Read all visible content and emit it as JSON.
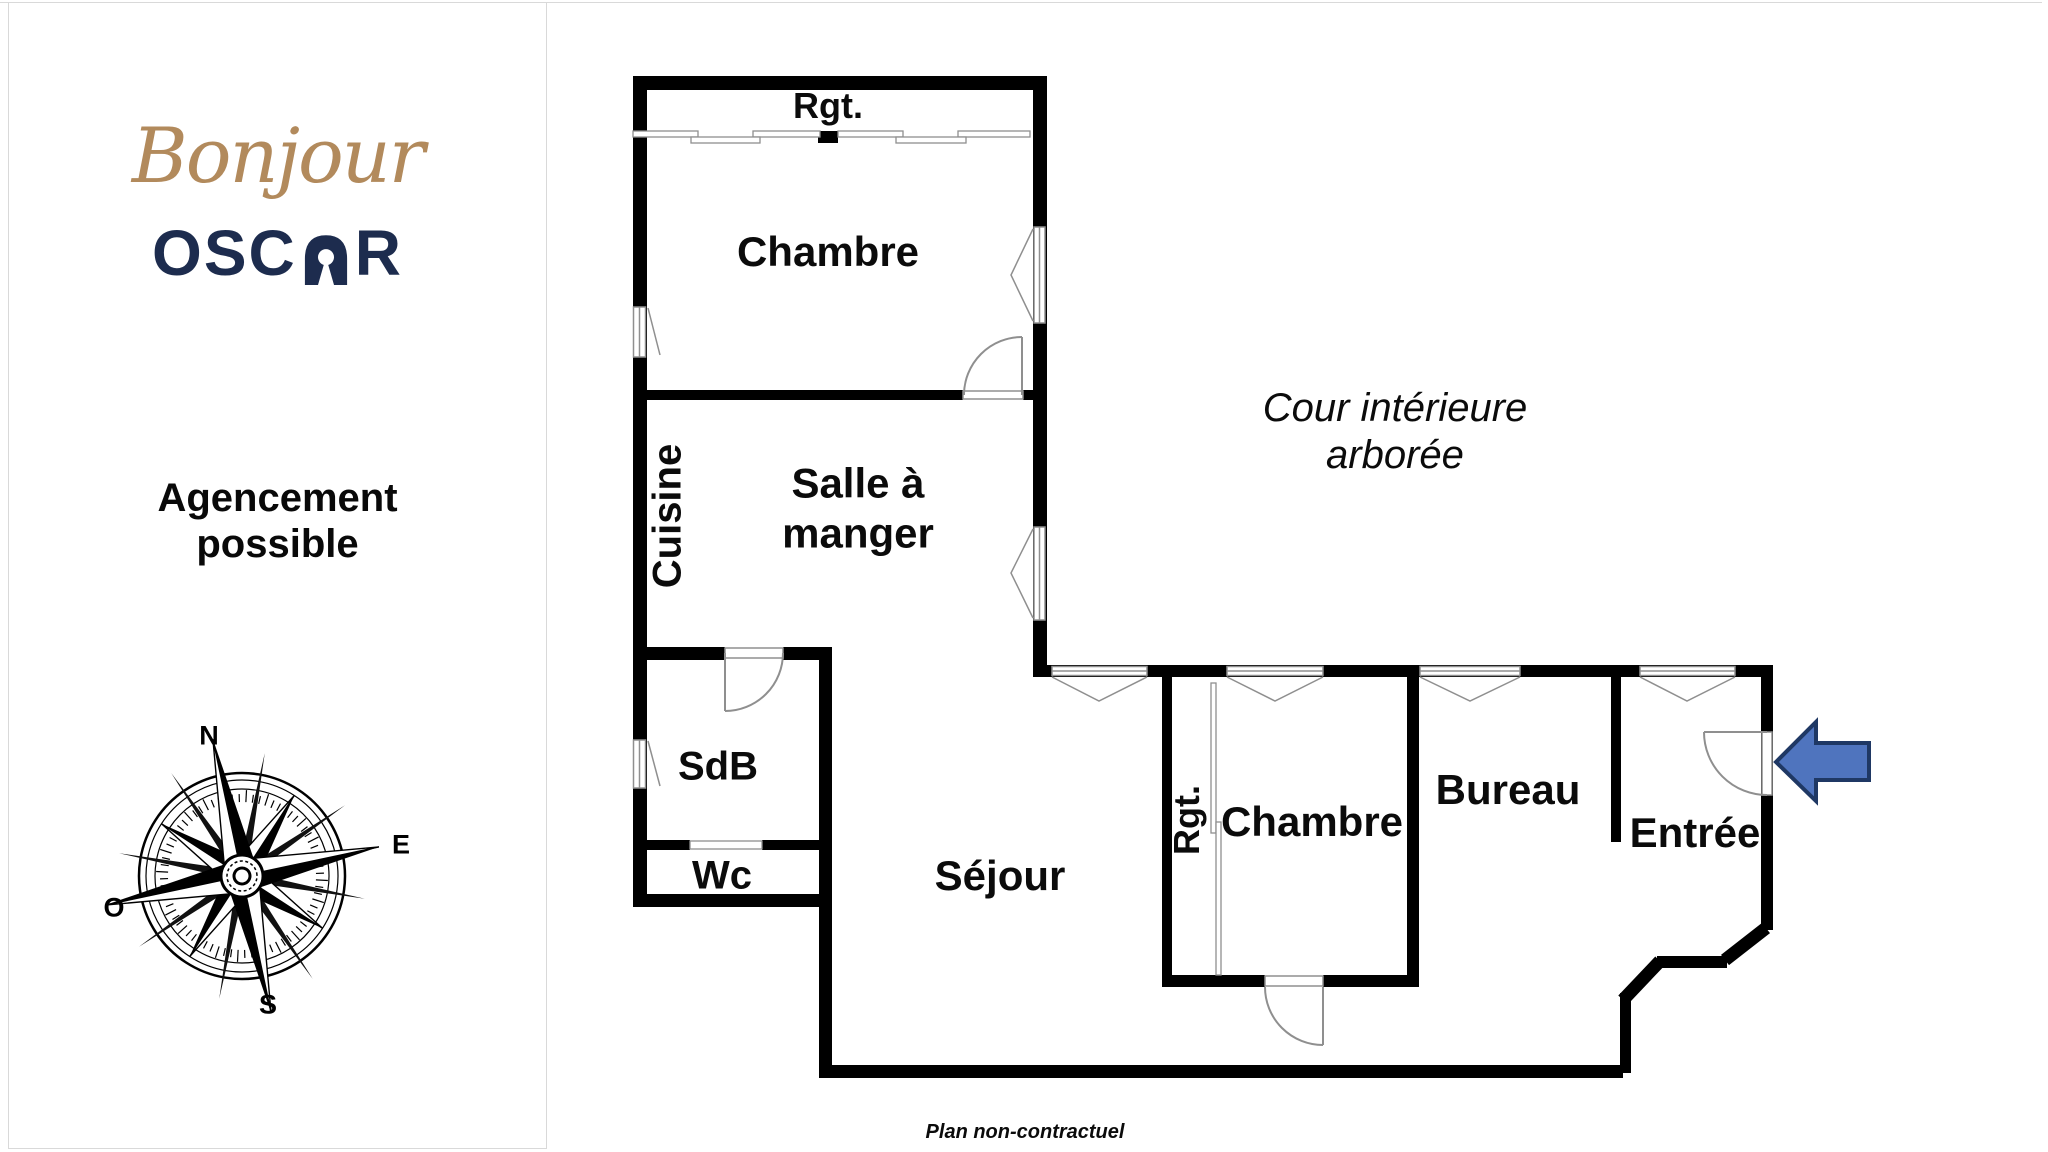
{
  "branding": {
    "script_word": "Bonjour",
    "brand_prefix": "OSC",
    "brand_suffix": "R",
    "gold": "#b28a5c",
    "navy": "#1d2c4e"
  },
  "left_panel": {
    "title_line1": "Agencement",
    "title_line2": "possible"
  },
  "compass": {
    "north": "N",
    "east": "E",
    "south": "S",
    "west": "O"
  },
  "plan": {
    "labels": {
      "storage_top": "Rgt.",
      "bedroom_top": "Chambre",
      "kitchen": "Cuisine",
      "dining_line1": "Salle à",
      "dining_line2": "manger",
      "bathroom": "SdB",
      "wc": "Wc",
      "living": "Séjour",
      "storage_wing": "Rgt.",
      "bedroom_wing": "Chambre",
      "office": "Bureau",
      "entrance": "Entrée",
      "courtyard_line1": "Cour intérieure",
      "courtyard_line2": "arborée",
      "disclaimer": "Plan non-contractuel"
    },
    "colors": {
      "wall": "#000000",
      "opening_stroke": "#8f8f8f",
      "arrow_fill": "#4f74be",
      "arrow_stroke": "#1f3864"
    }
  }
}
